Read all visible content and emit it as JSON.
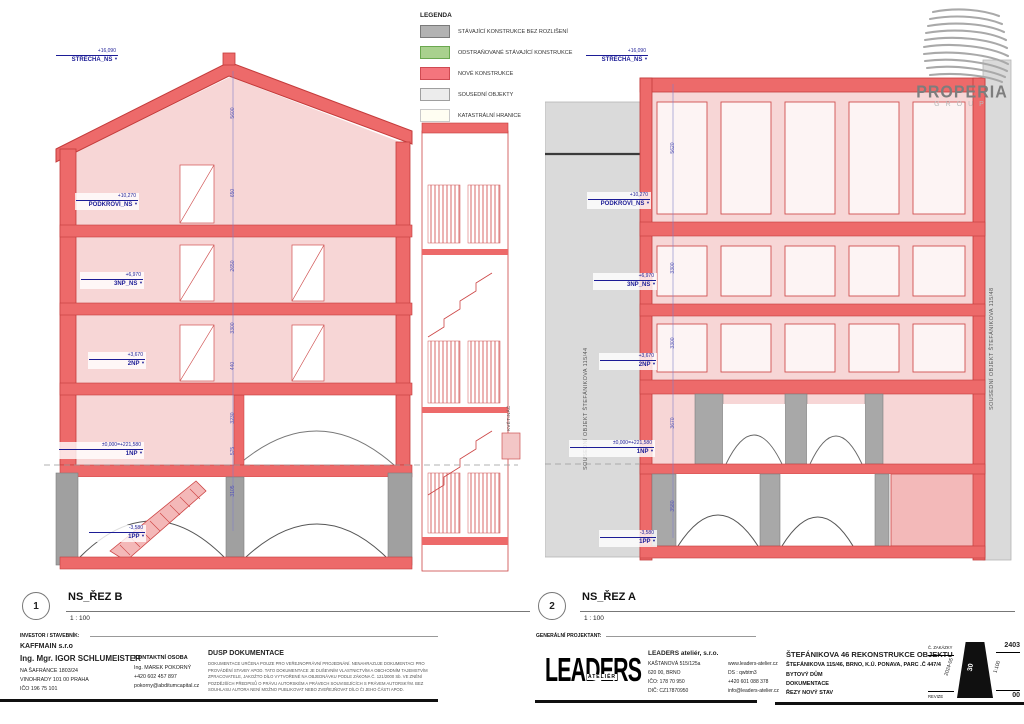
{
  "legend": {
    "title": "LEGENDA",
    "items": [
      {
        "label": "STÁVAJÍCÍ KONSTRUKCE BEZ ROZLIŠENÍ",
        "color": "#b2b2b2"
      },
      {
        "label": "ODSTRAŇOVANÉ STÁVAJÍCÍ KONSTRUKCE",
        "color": "#a9d18e"
      },
      {
        "label": "NOVÉ KONSTRUKCE",
        "color": "#f4757d"
      },
      {
        "label": "SOUSEDNÍ OBJEKTY",
        "color": "#ececec"
      },
      {
        "label": "KATASTRÁLNÍ HRANICE",
        "color": "#fffef2"
      }
    ]
  },
  "properia": {
    "line1": "PROPERIA",
    "line2": "GROUP"
  },
  "sections": {
    "b": {
      "number": "1",
      "title": "NS_ŘEZ B",
      "scale": "1 : 100",
      "annotation": "KVĚTINÁČ",
      "levels": [
        {
          "value": "+16,090",
          "name": "STŘECHA_NS"
        },
        {
          "value": "+10,270",
          "name": "PODKROVÍ_NS"
        },
        {
          "value": "+6,970",
          "name": "3NP_NS"
        },
        {
          "value": "+3,670",
          "name": "2NP"
        },
        {
          "value": "±0,000=+221,580",
          "name": "1NP"
        },
        {
          "value": "-3,580",
          "name": "1PP"
        }
      ],
      "dims": [
        "5600",
        "650",
        "2650",
        "3300",
        "440",
        "3230",
        "575",
        "3105"
      ]
    },
    "a": {
      "number": "2",
      "title": "NS_ŘEZ A",
      "scale": "1 : 100",
      "neighbor_left": "SOUSEDNÍ OBJEKT ŠTEFÁNIKOVA 115/44",
      "neighbor_right": "SOUSEDNÍ OBJEKT ŠTEFÁNIKOVA 115/48",
      "levels": [
        {
          "value": "+16,090",
          "name": "STŘECHA_NS"
        },
        {
          "value": "+10,270",
          "name": "PODKROVÍ_NS"
        },
        {
          "value": "+6,970",
          "name": "3NP_NS"
        },
        {
          "value": "+3,670",
          "name": "2NP"
        },
        {
          "value": "±0,000=+221,580",
          "name": "1NP"
        },
        {
          "value": "-3,580",
          "name": "1PP"
        }
      ],
      "dims": [
        "5620",
        "3300",
        "3300",
        "3670",
        "3580"
      ]
    }
  },
  "titleblock": {
    "investor_heading": "INVESTOR / STAVEBNÍK:",
    "investor_name": "KAFFMAIN s.r.o",
    "investor_person": "Ing. Mgr. IGOR SCHLUMEISTER",
    "investor_addr1": "NA ŠAFRÁNCE 1803/24",
    "investor_addr2": "VINOHRADY 101 00 PRAHA",
    "investor_ico": "IČO 196 75 101",
    "contact_heading": "KONTAKTNÍ OSOBA",
    "contact_name": "Ing. MAREK POKORNÝ",
    "contact_phone": "+420 602 457 897",
    "contact_email": "pokorny@abditumcapital.cz",
    "dusp_heading": "DUSP DOKUMENTACE",
    "dusp_text": "DOKUMENTACE URČENA POUZE PRO VEŘEJNOPRÁVNÍ PROJEDNÁNÍ. NENAHRAZUJE DOKUMENTACI PRO PROVÁDĚNÍ STAVBY APOD. TATO DOKUMENTACE JE DUŠEVNÍM VLASTNICTVÍM A OBCHODNÍM TAJEMSTVÍM ZPRACOVATELE, JAKOŽTO DÍLO VYTVOŘENÉ NA OBJEDNÁVKU PODLE ZÁKONA Č. 121/2000 Sb. VE ZNĚNÍ POZDĚJŠÍCH PŘEDPISŮ O PRÁVU AUTORSKÉM A PRÁVECH SOUVISEJÍCÍCH S PRÁVEM AUTORSKÝM. BEZ SOUHLASU AUTORA NENÍ MOŽNO PUBLIKOVAT NEBO ZVEŘEJŇOVAT DÍLO ČI JEHO ČÁSTI APOD.",
    "generalni_heading": "GENERÁLNÍ PROJEKTANT:",
    "leaders_logo_main": "LEADERS",
    "leaders_logo_sub": "ATELIÉR",
    "leaders_name": "LEADERS ateliér, s.r.o.",
    "leaders_addr1": "KAŠTANOVÁ 515/125a",
    "leaders_addr2": "620 00, BRNO",
    "leaders_ico": "IČO: 178 70 950",
    "leaders_dic": "DIČ: CZ17870950",
    "leaders_web": "www.leaders-atelier.cz",
    "leaders_ds": "DS : qwbtm3",
    "leaders_phone": "+420 601 088 378",
    "leaders_email": "info@leaders-atelier.cz",
    "project_title": "ŠTEFÁNIKOVA 46 REKONSTRUKCE OBJEKTU",
    "project_addr": "ŠTEFÁNIKOVA 115/46, BRNO, K.Ú. PONAVA, PARC .Č 447/4",
    "project_type": "BYTOVÝ DŮM",
    "project_doc": "DOKUMENTACE",
    "project_stage": "ŘEZY NOVÝ STAV",
    "stamp": {
      "zakazka_label": "Č. ZAKÁZKY",
      "zakazka_value": "2403",
      "date": "2024-05",
      "sheet": "30",
      "scale": "1:100",
      "revize_label": "REVIZE",
      "revize_value": "00"
    }
  },
  "colors": {
    "new_construction": "#ed6a6a",
    "new_fill": "#f7d6d6",
    "existing": "#a8a8a8",
    "neighbor": "#dadada",
    "level_text": "#1c1c96",
    "dimension_text": "#5353b4"
  }
}
